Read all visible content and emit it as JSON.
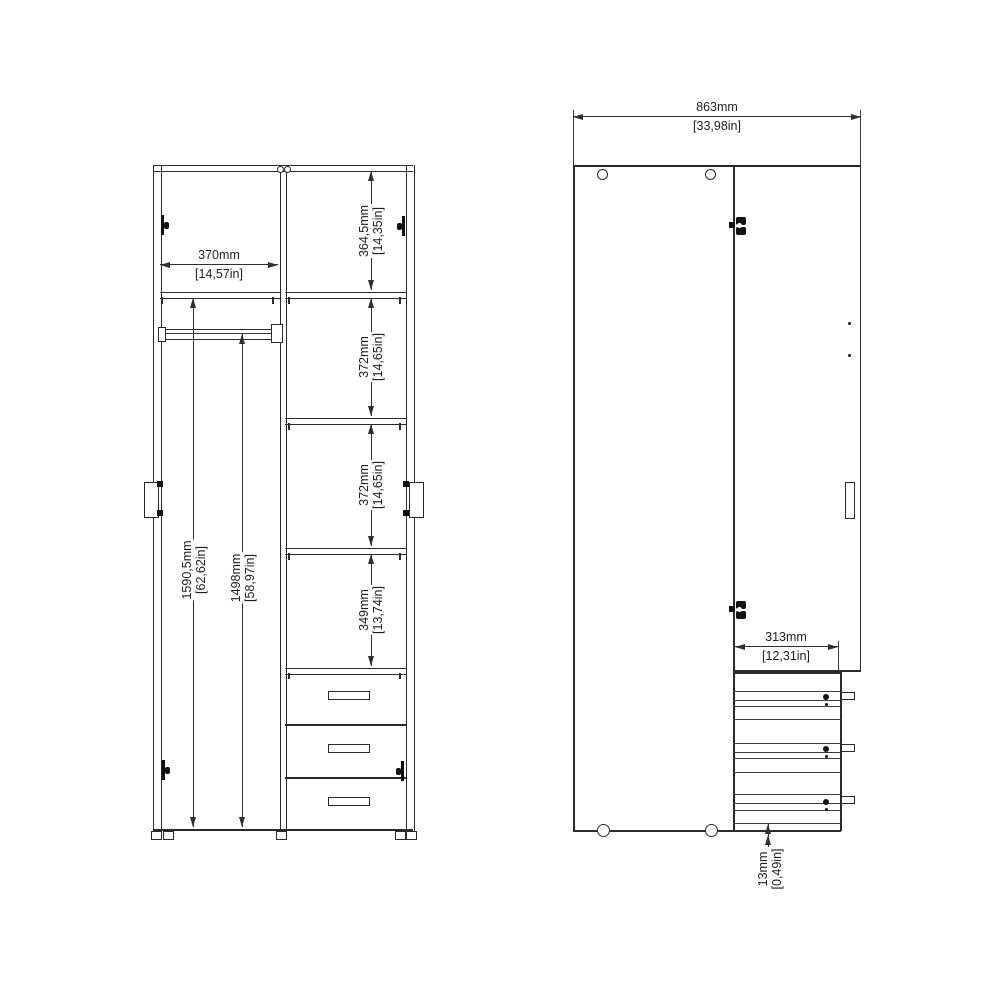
{
  "front_view": {
    "opening_width": {
      "mm": "370mm",
      "in": "[14,57in]"
    },
    "top_shelf_height": {
      "mm": "364,5mm",
      "in": "[14,35in]"
    },
    "shelf2_height": {
      "mm": "372mm",
      "in": "[14,65in]"
    },
    "shelf3_height": {
      "mm": "372mm",
      "in": "[14,65in]"
    },
    "shelf4_height": {
      "mm": "349mm",
      "in": "[13,74in]"
    },
    "interior_height": {
      "mm": "1590,5mm",
      "in": "[62,62in]"
    },
    "rail_height": {
      "mm": "1498mm",
      "in": "[58,97in]"
    }
  },
  "side_view": {
    "overall_width": {
      "mm": "863mm",
      "in": "[33,98in]"
    },
    "drawer_depth": {
      "mm": "313mm",
      "in": "[12,31in]"
    },
    "base_height": {
      "mm": "13mm",
      "in": "[0,49in]"
    }
  }
}
